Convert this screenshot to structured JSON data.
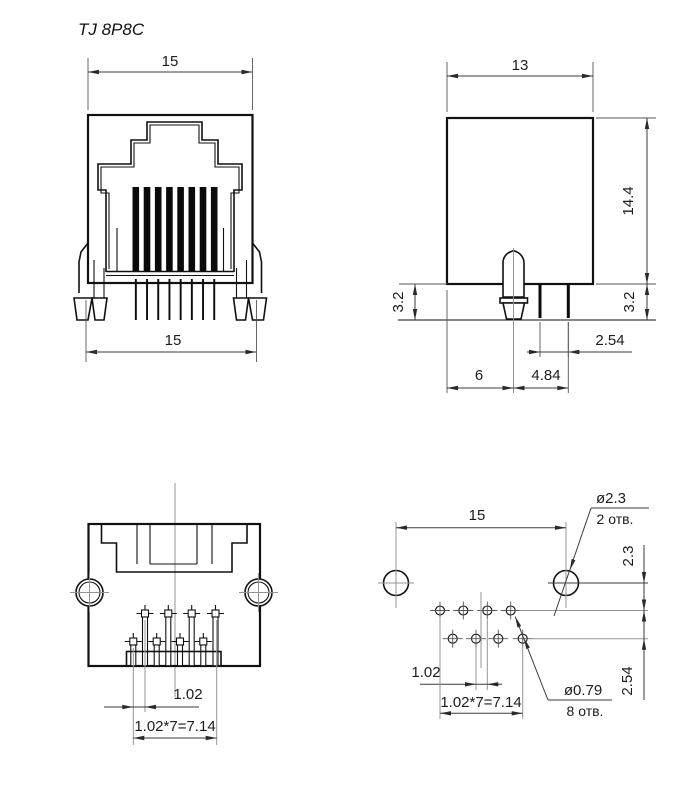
{
  "title": "TJ 8P8C",
  "front_view": {
    "width_top": "15",
    "width_bottom": "15"
  },
  "side_view": {
    "width": "13",
    "height": "14.4",
    "pin_protrusion_left": "3.2",
    "pin_protrusion_right": "3.2",
    "pin_pitch": "2.54",
    "peg_offset": "6",
    "peg_to_last_pin": "4.84"
  },
  "bottom_view": {
    "row_offset": "1.02",
    "pin_span": "1.02*7=7.14"
  },
  "pcb_view": {
    "peg_hole_spacing": "15",
    "peg_hole_dia": "ø2.3",
    "peg_hole_count": "2 отв.",
    "peg_to_row": "2.3",
    "row_pitch": "2.54",
    "hole_offset": "1.02",
    "hole_span": "1.02*7=7.14",
    "pin_hole_dia": "ø0.79",
    "pin_hole_count": "8 отв."
  }
}
